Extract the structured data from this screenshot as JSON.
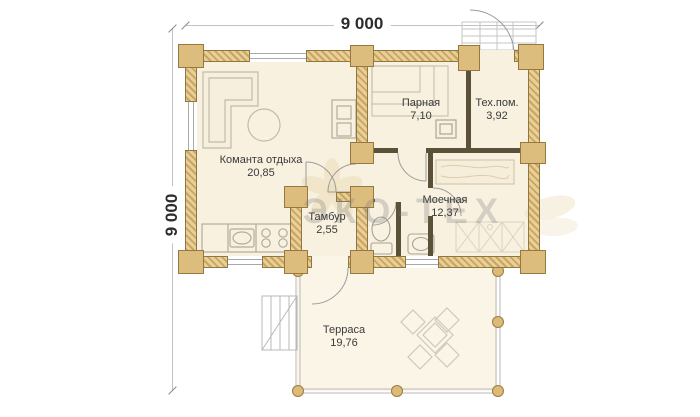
{
  "dimensions": {
    "width_label": "9 000",
    "height_label": "9 000"
  },
  "watermark": {
    "text": "ЭКО-ТЕХ"
  },
  "rooms": [
    {
      "name": "Команта отдыха",
      "area": "20,85"
    },
    {
      "name": "Парная",
      "area": "7,10"
    },
    {
      "name": "Тех.пом.",
      "area": "3,92"
    },
    {
      "name": "Моечная",
      "area": "12,37"
    },
    {
      "name": "Тамбур",
      "area": "2,55"
    },
    {
      "name": "Терраса",
      "area": "19,76"
    }
  ],
  "colors": {
    "log_wall": "#dcbc7c",
    "partition": "#5a5138",
    "floor": "#f8f1e0",
    "terrace_floor": "#fbf5e8",
    "label_text": "#3a3a3a",
    "dimension_text": "#2d2d2d",
    "watermark_text": "#9a9a9a"
  }
}
